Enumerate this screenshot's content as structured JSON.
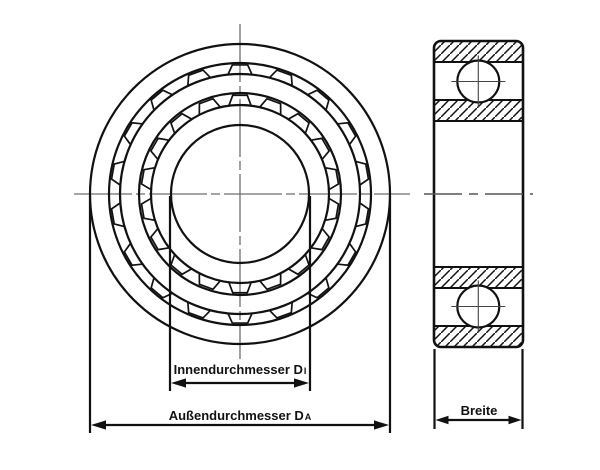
{
  "labels": {
    "inner": {
      "text": "Innendurchmesser D",
      "sub": "I"
    },
    "outer": {
      "text": "Außendurchmesser D",
      "sub": "A"
    },
    "width": {
      "text": "Breite"
    }
  },
  "colors": {
    "background": "#ffffff",
    "line": "#111111",
    "centerline": "#6e6e6e",
    "crosshair": "#444444"
  },
  "front_view": {
    "center": {
      "x": 240,
      "y": 194
    },
    "circle_radii": [
      150,
      131,
      120,
      101,
      89,
      69
    ],
    "cage": {
      "bridge_count": 18,
      "bridge_angles_deg": [
        90,
        110,
        130,
        150,
        170,
        190,
        210,
        230,
        250,
        270,
        290,
        310,
        330,
        350,
        10,
        30,
        50,
        70
      ],
      "outer_band": {
        "chord_r": 129.3,
        "chord_half_deg": 3.4,
        "base_r": 120.6,
        "base_half_deg": 5.6
      },
      "inner_band": {
        "chord_r": 99.0,
        "chord_half_deg": 4.2,
        "base_r": 89.6,
        "base_half_deg": 7.0
      }
    },
    "v_centerline": {
      "x": 240,
      "y1": 24,
      "y2": 359
    },
    "h_centerline": {
      "y": 194,
      "x1": 74,
      "x2": 410
    }
  },
  "side_view": {
    "outline": {
      "x": 434,
      "y": 41,
      "w": 89,
      "h": 306,
      "rx": 7
    },
    "hatch_band_ys": [
      41,
      100,
      267,
      326
    ],
    "band_height": 21,
    "band_edge_ys": [
      62,
      100,
      121,
      267,
      288,
      326
    ],
    "balls": [
      {
        "cx": 478.3,
        "cy": 81.5,
        "r": 21
      },
      {
        "cx": 478.3,
        "cy": 306.5,
        "r": 21
      }
    ],
    "centerline": {
      "y": 194,
      "x1": 424,
      "x2": 533
    }
  },
  "dimensions": {
    "inner": {
      "ext_x1": 170,
      "ext_x2": 310,
      "ext_y1": 196,
      "ext_y2": 391,
      "line_y": 383
    },
    "outer": {
      "ext_x1": 90,
      "ext_x2": 390,
      "ext_y1": 196,
      "ext_y2": 433,
      "line_y": 425
    },
    "width": {
      "ext_x1": 434.5,
      "ext_x2": 522.5,
      "ext_y1": 349,
      "ext_y2": 429,
      "line_y": 420
    }
  }
}
